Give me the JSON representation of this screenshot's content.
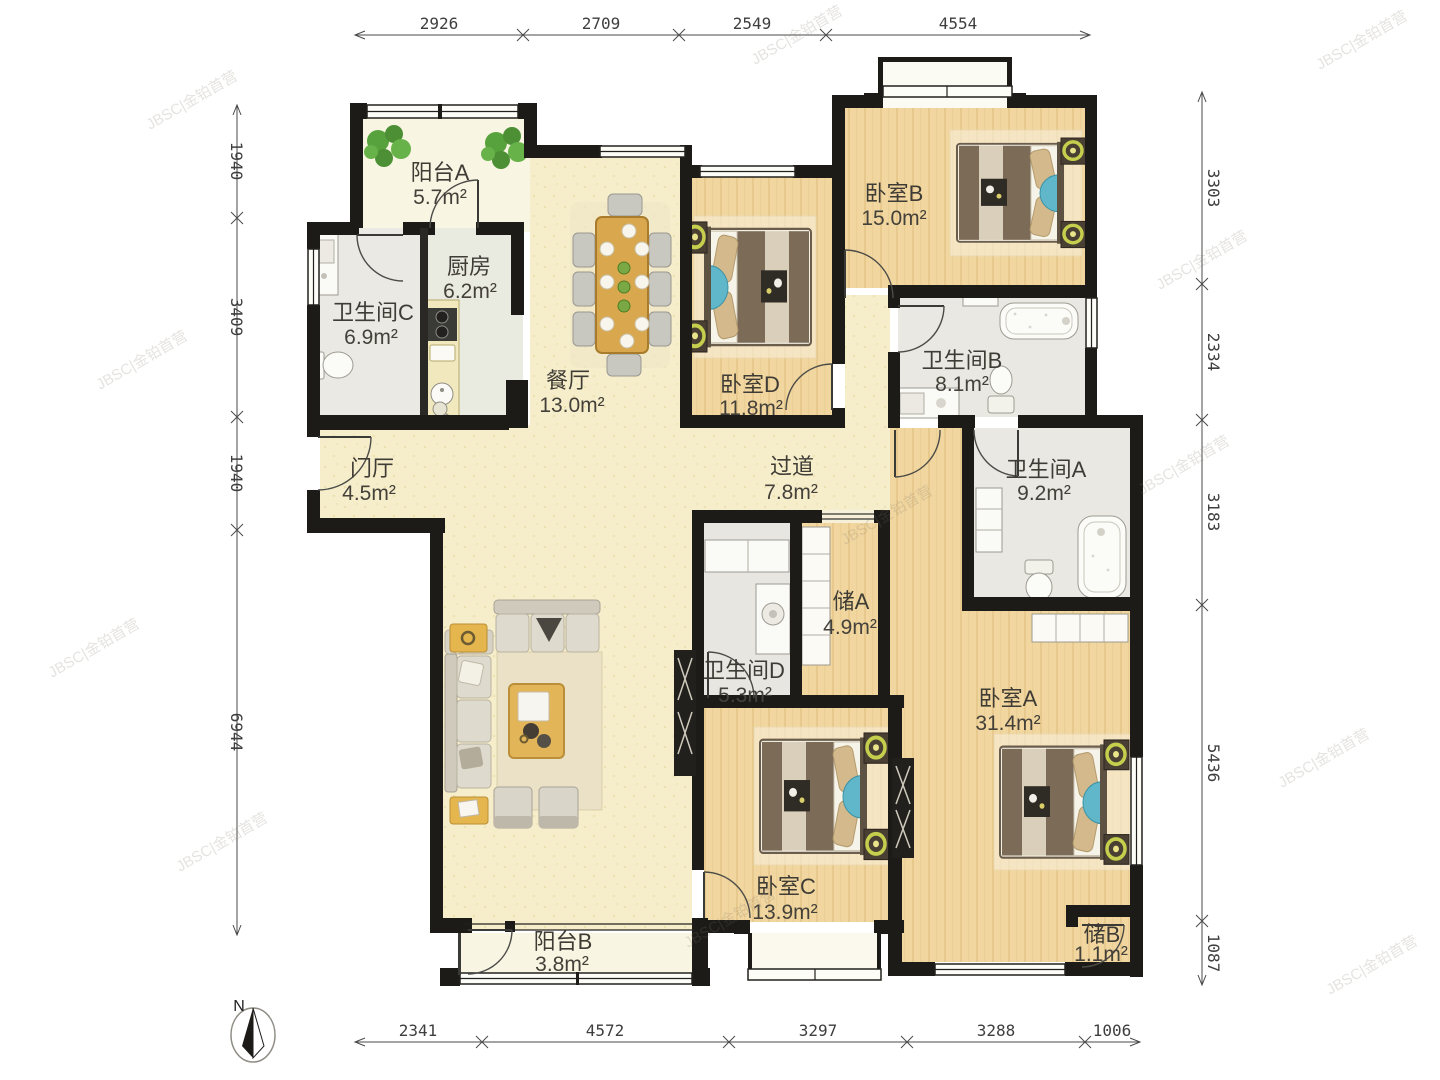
{
  "watermark": "JBSC|金铂首营",
  "compass": {
    "north_label": "N"
  },
  "colors": {
    "wall": "#1d1b18",
    "wood_floor": "#f1d69f",
    "cream_floor": "#f6eecb",
    "bath_floor": "#e9e8e2",
    "balcony_floor": "#f8f5e2",
    "accent_table": "#d9a84e",
    "accent_lamp": "#c6cf4d",
    "accent_fan": "#5fb7c9"
  },
  "dimensions": {
    "top": [
      "2926",
      "2709",
      "2549",
      "4554"
    ],
    "bottom": [
      "2341",
      "4572",
      "3297",
      "3288",
      "1006"
    ],
    "left": [
      "1940",
      "3409",
      "1940",
      "6944"
    ],
    "right": [
      "3303",
      "2334",
      "3183",
      "5436",
      "1087"
    ]
  },
  "rooms": {
    "balcony_a": {
      "name": "阳台A",
      "area": "5.7m²"
    },
    "kitchen": {
      "name": "厨房",
      "area": "6.2m²"
    },
    "bath_c": {
      "name": "卫生间C",
      "area": "6.9m²"
    },
    "dining": {
      "name": "餐厅",
      "area": "13.0m²"
    },
    "bedroom_d": {
      "name": "卧室D",
      "area": "11.8m²"
    },
    "bedroom_b": {
      "name": "卧室B",
      "area": "15.0m²"
    },
    "bath_b": {
      "name": "卫生间B",
      "area": "8.1m²"
    },
    "corridor": {
      "name": "过道",
      "area": "7.8m²"
    },
    "foyer": {
      "name": "门厅",
      "area": "4.5m²"
    },
    "bath_a": {
      "name": "卫生间A",
      "area": "9.2m²"
    },
    "storage_a": {
      "name": "储A",
      "area": "4.9m²"
    },
    "bath_d": {
      "name": "卫生间D",
      "area": "5.3m²"
    },
    "bedroom_a": {
      "name": "卧室A",
      "area": "31.4m²"
    },
    "bedroom_c": {
      "name": "卧室C",
      "area": "13.9m²"
    },
    "balcony_b": {
      "name": "阳台B",
      "area": "3.8m²"
    },
    "storage_b": {
      "name": "储B",
      "area": "1.1m²"
    }
  }
}
